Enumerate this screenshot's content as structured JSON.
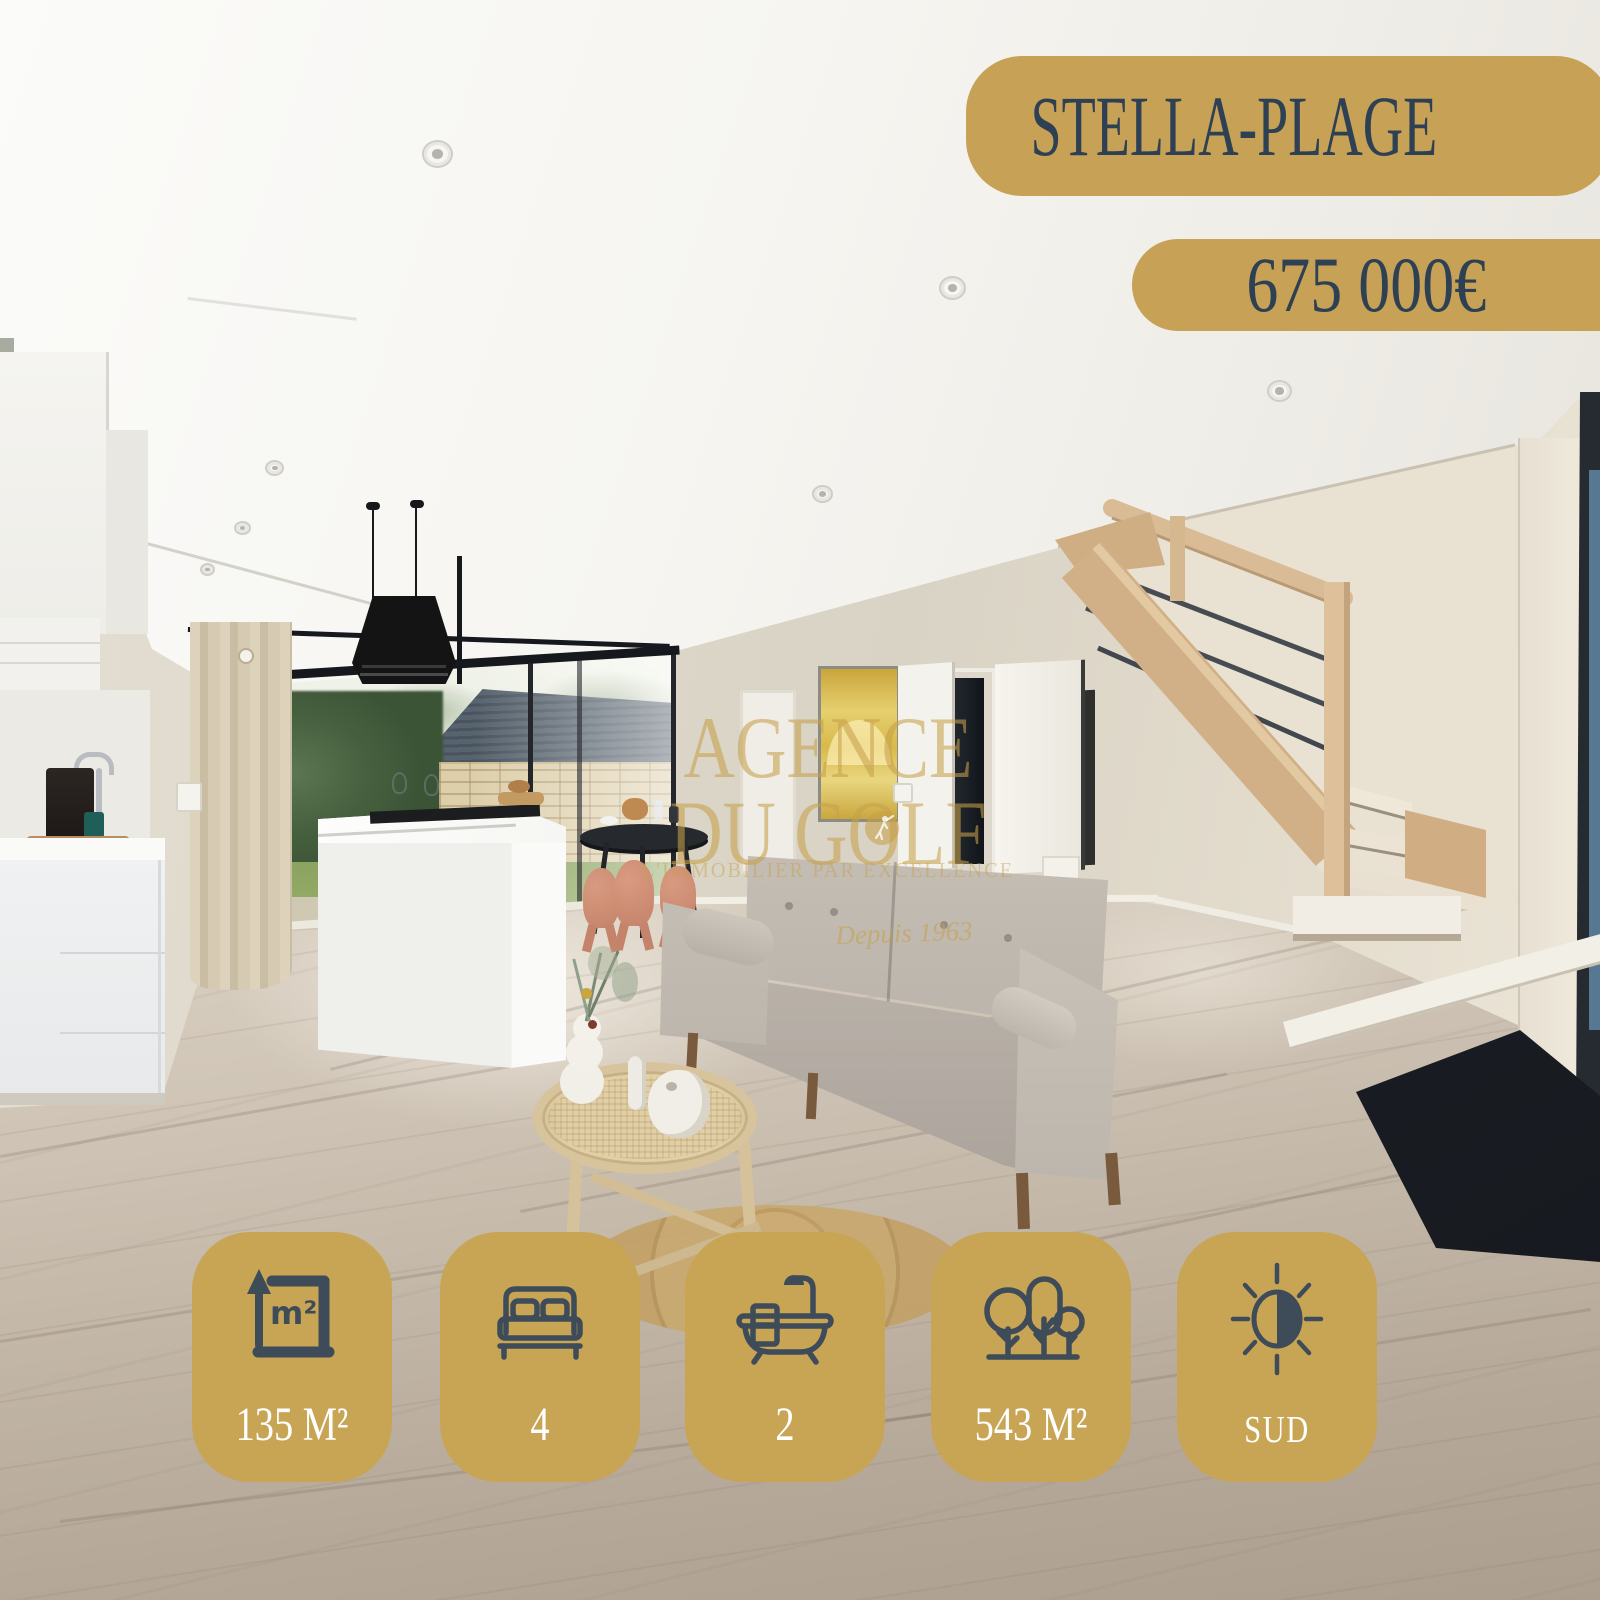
{
  "badges": {
    "location": "STELLA-PLAGE",
    "price": "675 000€"
  },
  "features": [
    {
      "name": "living-area",
      "icon": "area-m2-icon",
      "icon_label": "m²",
      "value": "135 M²"
    },
    {
      "name": "bedrooms",
      "icon": "bed-icon",
      "value": "4"
    },
    {
      "name": "bathrooms",
      "icon": "bathtub-icon",
      "value": "2"
    },
    {
      "name": "land-area",
      "icon": "trees-icon",
      "value": "543 M²"
    },
    {
      "name": "orientation",
      "icon": "sun-half-icon",
      "value": "SUD"
    }
  ],
  "watermark": {
    "brand_line1": "AGENCE",
    "brand_line2": "DU GOLF",
    "tagline": "L'IMMOBILIER PAR EXCELLENCE",
    "since": "Depuis 1963"
  },
  "colors": {
    "badge_gold": "#c7a155",
    "badge_navy": "#2e4053",
    "icon_slate": "#3e4b58",
    "feature_text": "#ffffff",
    "watermark_gold": "#c6a04a"
  }
}
